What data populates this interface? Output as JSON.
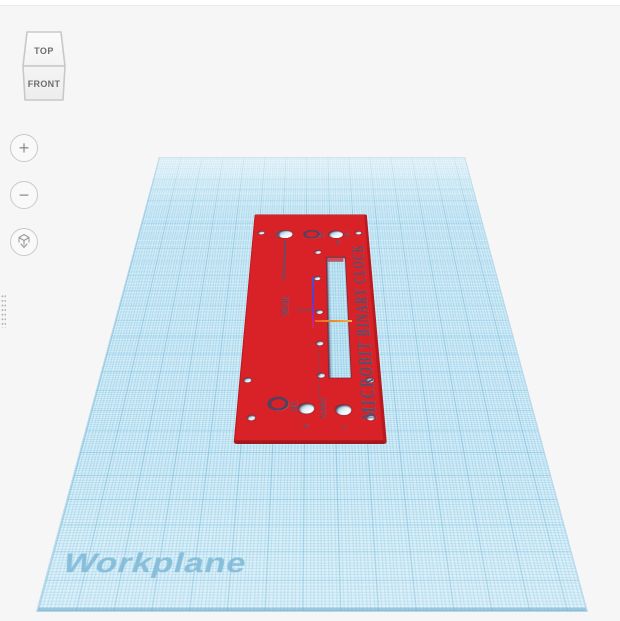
{
  "viewcube": {
    "top": "TOP",
    "front": "FRONT"
  },
  "nav": {
    "zoom_in": "+",
    "zoom_out": "−"
  },
  "workplane": {
    "label": "Workplane"
  },
  "plate": {
    "title": "MICROBIT BINARY CLOCK",
    "labels": {
      "brt": "BRT",
      "set": "SET",
      "min": "MIN",
      "hr": "HR",
      "mode": "MODE",
      "sel": "SEL",
      "alarm": "ALARM",
      "btn_b": "B",
      "btn_a": "A"
    }
  },
  "colors": {
    "plate_red": "#d92227",
    "engraving": "#524f6e",
    "workplane_fill": "#daeef8",
    "grid_major": "#54a6cd",
    "axis_blue": "#4a4fd4",
    "axis_orange": "#f59d38",
    "background": "#f6f6f7"
  }
}
